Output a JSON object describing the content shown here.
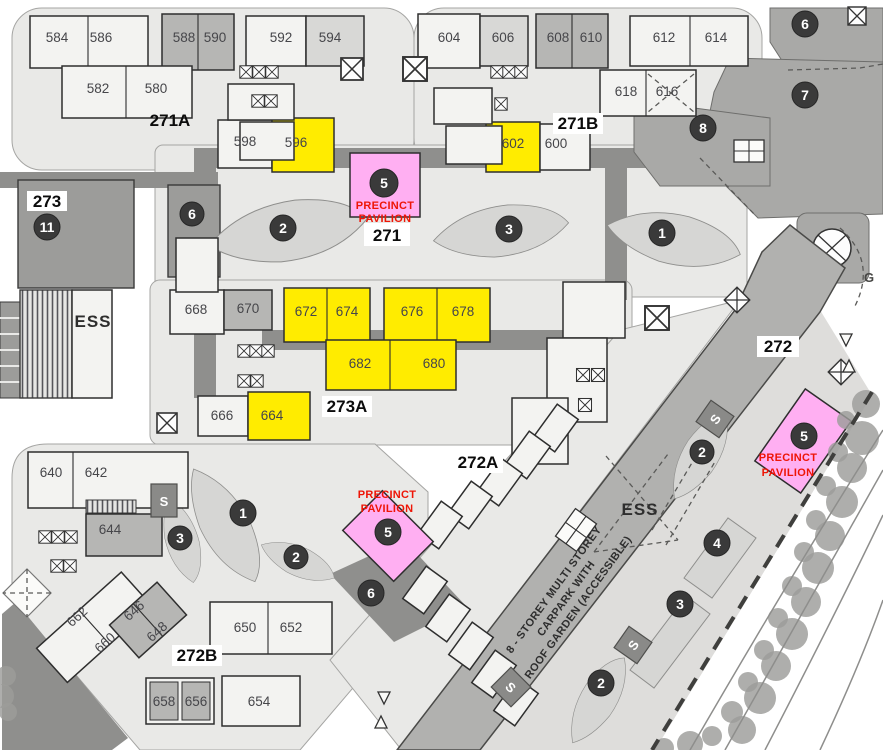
{
  "map_title": "Precinct site map",
  "areas": {
    "a271": "271",
    "a271A": "271A",
    "a271B": "271B",
    "a272": "272",
    "a272A": "272A",
    "a272B": "272B",
    "a273": "273",
    "a273A": "273A"
  },
  "blocks": {
    "b580": "580",
    "b582": "582",
    "b584": "584",
    "b586": "586",
    "b588": "588",
    "b590": "590",
    "b592": "592",
    "b594": "594",
    "b596": "596",
    "b598": "598",
    "b600": "600",
    "b602": "602",
    "b604": "604",
    "b606": "606",
    "b608": "608",
    "b610": "610",
    "b612": "612",
    "b614": "614",
    "b616": "616",
    "b618": "618",
    "b640": "640",
    "b642": "642",
    "b644": "644",
    "b646": "646",
    "b648": "648",
    "b650": "650",
    "b652": "652",
    "b654": "654",
    "b656": "656",
    "b658": "658",
    "b660": "660",
    "b662": "662",
    "b664": "664",
    "b666": "666",
    "b668": "668",
    "b670": "670",
    "b672": "672",
    "b674": "674",
    "b676": "676",
    "b678": "678",
    "b680": "680",
    "b682": "682"
  },
  "badges": {
    "n1": "1",
    "n2": "2",
    "n3": "3",
    "n4": "4",
    "n5": "5",
    "n6": "6",
    "n7": "7",
    "n8": "8",
    "n11": "11"
  },
  "pavilions": {
    "line1": "PRECINCT",
    "line2": "PAVILION"
  },
  "facilities": {
    "ess": "ESS",
    "substation": "S",
    "garden_point": "G",
    "carpark_line1": "8 - STOREY MULTI STOREY",
    "carpark_line2": "CARPARK WITH",
    "carpark_line3": "ROOF GARDEN (ACCESSIBLE)"
  },
  "colors": {
    "highlight_block": "#ffec00",
    "pavilion_fill": "#ffaff2",
    "pavilion_text": "#ee1506",
    "badge_fill": "#3a3a3a",
    "road_band": "#8f8f8d",
    "area_fill": "#e9e9e7"
  }
}
